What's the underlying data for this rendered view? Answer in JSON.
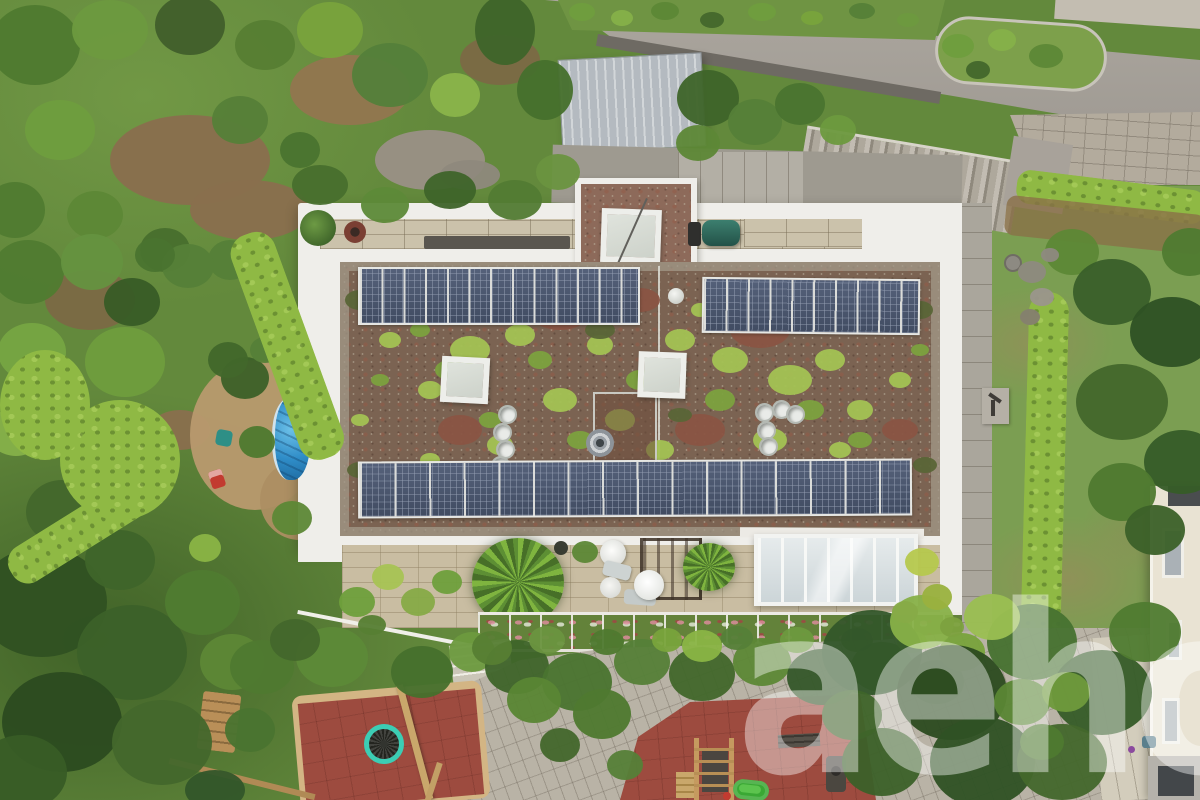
{
  "scene": {
    "type": "aerial-drone-photograph",
    "subject": "Top-down view of a modern flat-roof multi-family house with extensive sedum green roof, two long rows of photovoltaic panels, skylights, roof terrace courtyard, garden with trimmed hedges, small round pool, playground with red rubber flooring and trampoline, access road with exterior concrete stairs",
    "watermark": {
      "text": "aeho"
    },
    "solar_arrays": {
      "top_left_modules": 13,
      "top_right_modules": 10,
      "bottom_row_modules": 16
    },
    "features": [
      "green-roof",
      "solar-panels",
      "skylights",
      "roof-vents",
      "conservatory",
      "terrace-furniture",
      "palms",
      "planter-boxes",
      "pool",
      "trampoline",
      "climbing-frame",
      "slide",
      "benches",
      "hedges",
      "lawn",
      "road",
      "stairs",
      "metal-roof-outbuilding",
      "neighbor-house"
    ]
  },
  "palette": {
    "asphalt": "#a7a29a",
    "paver": "#b9b3a6",
    "cobble": "#b3ab9d",
    "parapet": "#efeeea",
    "terrace_paver": "#c9bda2",
    "green_roof_base": "#7b6352",
    "sedum_bright": "#a4c254",
    "sedum_mid": "#7da23f",
    "substrate_red": "#8a5544",
    "solar_cell": "#47536b",
    "solar_frame": "#e6e7e4",
    "metal_roof": "#bfc5c9",
    "hedge_bright": "#8fb944",
    "lawn": "#7b9e52",
    "mulch": "#b99a6e",
    "pool_blue": "#2f8dc8",
    "play_red": "#9d4b3f",
    "sand": "#d3b584",
    "trampoline_ring": "#3ccdb4",
    "slide_green": "#3aa834",
    "wood": "#c9a76b",
    "watermark": "rgba(255,255,255,0.42)"
  }
}
